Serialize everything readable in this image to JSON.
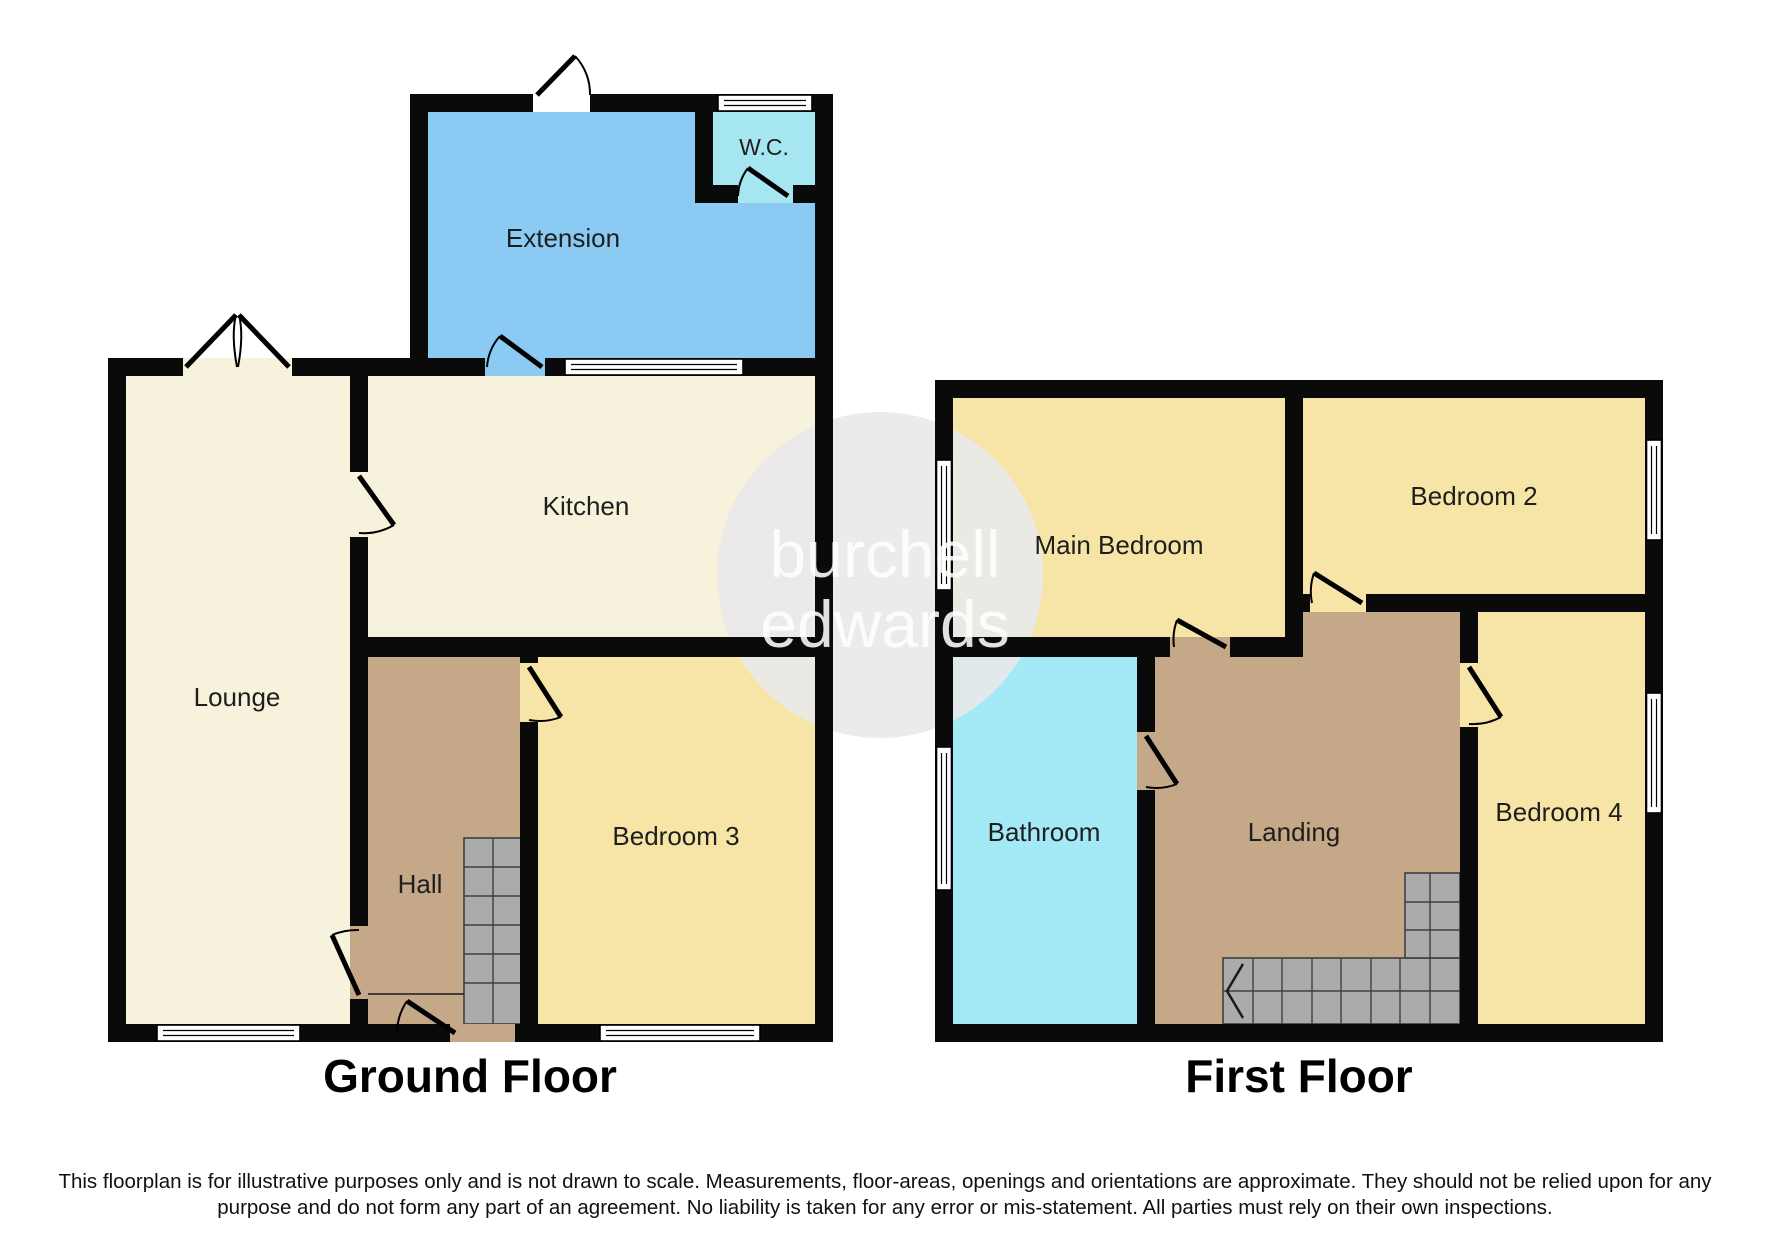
{
  "ground_floor": {
    "title": "Ground Floor",
    "extension": "Extension",
    "wc": "W.C.",
    "kitchen": "Kitchen",
    "lounge": "Lounge",
    "hall": "Hall",
    "bedroom3": "Bedroom 3"
  },
  "first_floor": {
    "title": "First Floor",
    "main_bedroom": "Main Bedroom",
    "bedroom2": "Bedroom 2",
    "bathroom": "Bathroom",
    "landing": "Landing",
    "bedroom4": "Bedroom 4"
  },
  "watermark": {
    "line1": "burchell",
    "line2": "edwards"
  },
  "disclaimer": {
    "line1": "This floorplan is for illustrative purposes only and is not drawn to scale. Measurements, floor-areas, openings and orientations are approximate. They should not be relied upon for any",
    "line2": "purpose and do not form any part of an agreement. No liability is taken for any error or mis-statement. All parties must rely on their own inspections."
  },
  "colors": {
    "wall": "#0a0a0a",
    "extension": "#8bcbf3",
    "wc": "#a6e6f0",
    "bathroom": "#a4e9f6",
    "cream": "#f7f2db",
    "bedroom_yellow": "#f7e5a8",
    "hall_brown": "#c5a888",
    "stairs_gray": "#ababab",
    "watermark_gray": "#e9e9e9"
  }
}
